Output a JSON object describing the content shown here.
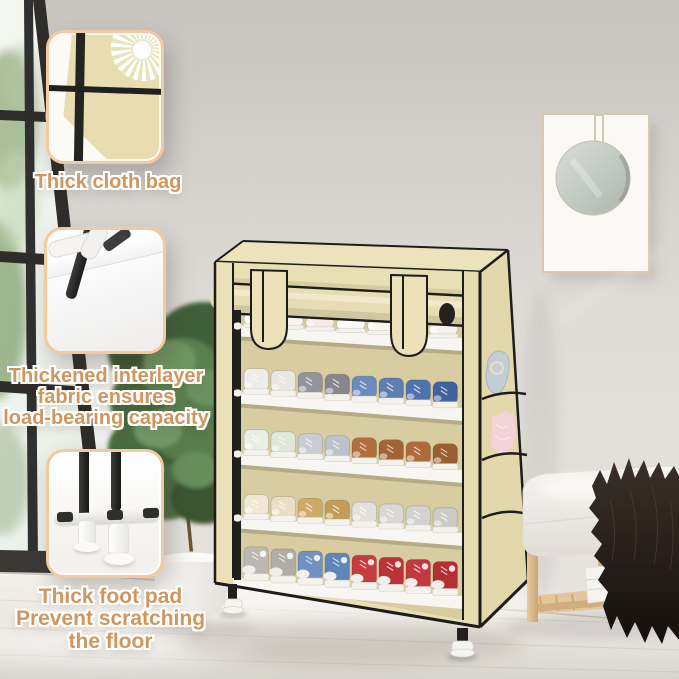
{
  "callouts": [
    {
      "id": "thick-cloth-bag",
      "label": "Thick cloth bag"
    },
    {
      "id": "thickened-interlayer",
      "lines": [
        "Thickened interlayer",
        "fabric ensures",
        "load-bearing capacity"
      ]
    },
    {
      "id": "thick-foot-pad",
      "lines": [
        "Thick foot pad",
        "Prevent scratching",
        "the floor"
      ]
    }
  ],
  "rack": {
    "shelf_count": 5,
    "cover_color": "#e9dfb5",
    "trim_color": "#1d1d1b",
    "shelf_color": "#f7f6f2",
    "rows": [
      {
        "name": "white-slippers-row",
        "shoes": [
          "#fdfcfa",
          "#f8f3ee",
          "#f4e9e3",
          "#fbfaf8",
          "#f7f5f1",
          "#fcfbf9",
          "#f5f2ee"
        ]
      },
      {
        "name": "sneakers-row",
        "shoes": [
          "#efede9",
          "#e9e7e2",
          "#93939b",
          "#86868e",
          "#6c8aba",
          "#5d7fb2",
          "#4f73ac",
          "#41629f"
        ]
      },
      {
        "name": "runners-row",
        "shoes": [
          "#e8efe4",
          "#dfe9db",
          "#c8cdd3",
          "#bcc2ca",
          "#b06f3d",
          "#a26435",
          "#ac6b3a",
          "#9a5e31"
        ]
      },
      {
        "name": "suede-row",
        "shoes": [
          "#f0e8d4",
          "#e9dfc6",
          "#cfa967",
          "#c39c5b",
          "#e2e1dd",
          "#d9d8d4",
          "#d3d2ce",
          "#cccbc7"
        ]
      },
      {
        "name": "high-tops-row",
        "shoes": [
          "#bcb8b1",
          "#b1ada6",
          "#7191c2",
          "#6285b8",
          "#c63b40",
          "#bb3338",
          "#c2383d",
          "#b22f34"
        ]
      }
    ],
    "pocket_items": [
      {
        "name": "shoe-horn",
        "color": "#c2cdd6"
      },
      {
        "name": "plush-toy",
        "color": "#f3d3d8"
      }
    ]
  },
  "palette": {
    "wall_top": "#c9c6c1",
    "wall_bottom": "#e8e5e0",
    "floor": "#efece6",
    "window_frame": "#2e2d2b",
    "foliage": "#55794a",
    "callout_border": "#f2c9a0",
    "callout_text": "#cf9660",
    "bench_wood": "#ddc094",
    "fur": "#221b17",
    "mirror_glass": "#c3cac4"
  }
}
